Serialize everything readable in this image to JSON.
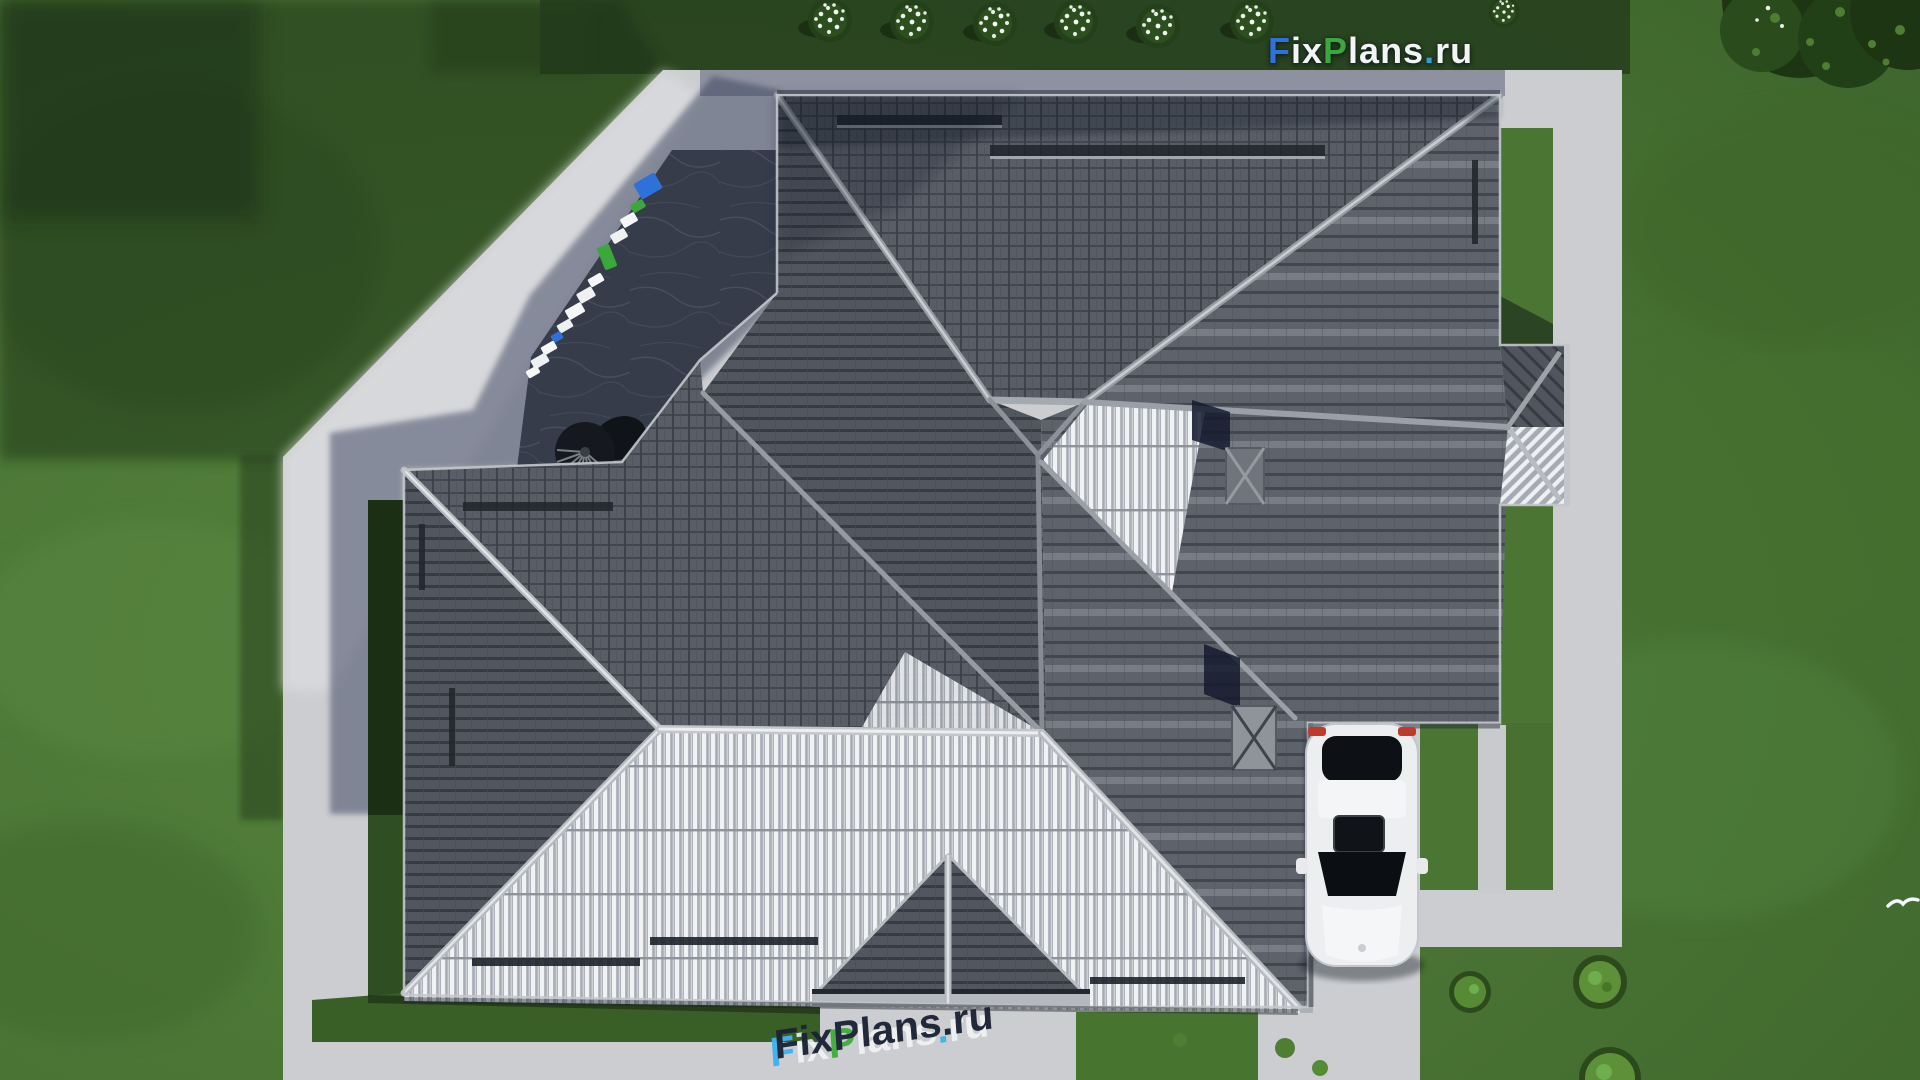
{
  "watermarks": {
    "top_logo": {
      "text": "FixPlans.ru",
      "parts": [
        {
          "t": "F",
          "color": "#2e72d9"
        },
        {
          "t": "ix",
          "color": "#f2f4f6"
        },
        {
          "t": "P",
          "color": "#3aa83a"
        },
        {
          "t": "lans",
          "color": "#f2f4f6"
        },
        {
          "t": ".",
          "color": "#2f9fe0"
        },
        {
          "t": "ru",
          "color": "#f2f4f6"
        }
      ]
    },
    "ground_mark": {
      "text": "FixPlans.ru",
      "parts": [
        {
          "t": "F"
        },
        {
          "t": "ix"
        },
        {
          "t": "P"
        },
        {
          "t": "lans"
        },
        {
          "t": "."
        },
        {
          "t": "ru"
        }
      ],
      "top_color": "#1b2334",
      "side_colors": {
        "F": "#3cb4f0",
        "P": "#3fae3a",
        "dot": "#3cb4f0",
        "default": "#f0f2f4"
      }
    },
    "walkway_marker": {
      "text": "FixPlans.ru",
      "style": "3D letter blocks viewed from above on shaded walkway",
      "colors": [
        "#2e72d9",
        "#3aa83a",
        "#ffffff"
      ]
    }
  },
  "scene": {
    "view": "top-down 3D architectural render of a hip-roof house",
    "objects": {
      "house_roof": "dark tiled hip roof with light ridge caps and snow guards",
      "car": "white sedan parked on driveway, top view",
      "terrace": "dark stone patio, upper left",
      "ceiling_fan": "round fan/parasol on terrace",
      "lawn": "green grass with mottling",
      "paths": "light concrete walkways and driveway",
      "bushes": "row of white flowering shrubs along top edge",
      "trees": "dark green trees in top-right corner",
      "bird": "small white bird flying at right"
    },
    "palette": {
      "lawn": "#4d7836",
      "lawn_dark": "#263f1e",
      "concrete": "#cbcdd0",
      "concrete_shadow": "#8e94a6",
      "roof_dark": "#565a64",
      "roof_gap": "#33363e",
      "roof_ridge": "#aaaeb6",
      "roof_lit_stripe": "#f2f3f5",
      "terrace": "#3d4251",
      "car": "#eceef0",
      "taillight": "#c03a2c"
    }
  }
}
